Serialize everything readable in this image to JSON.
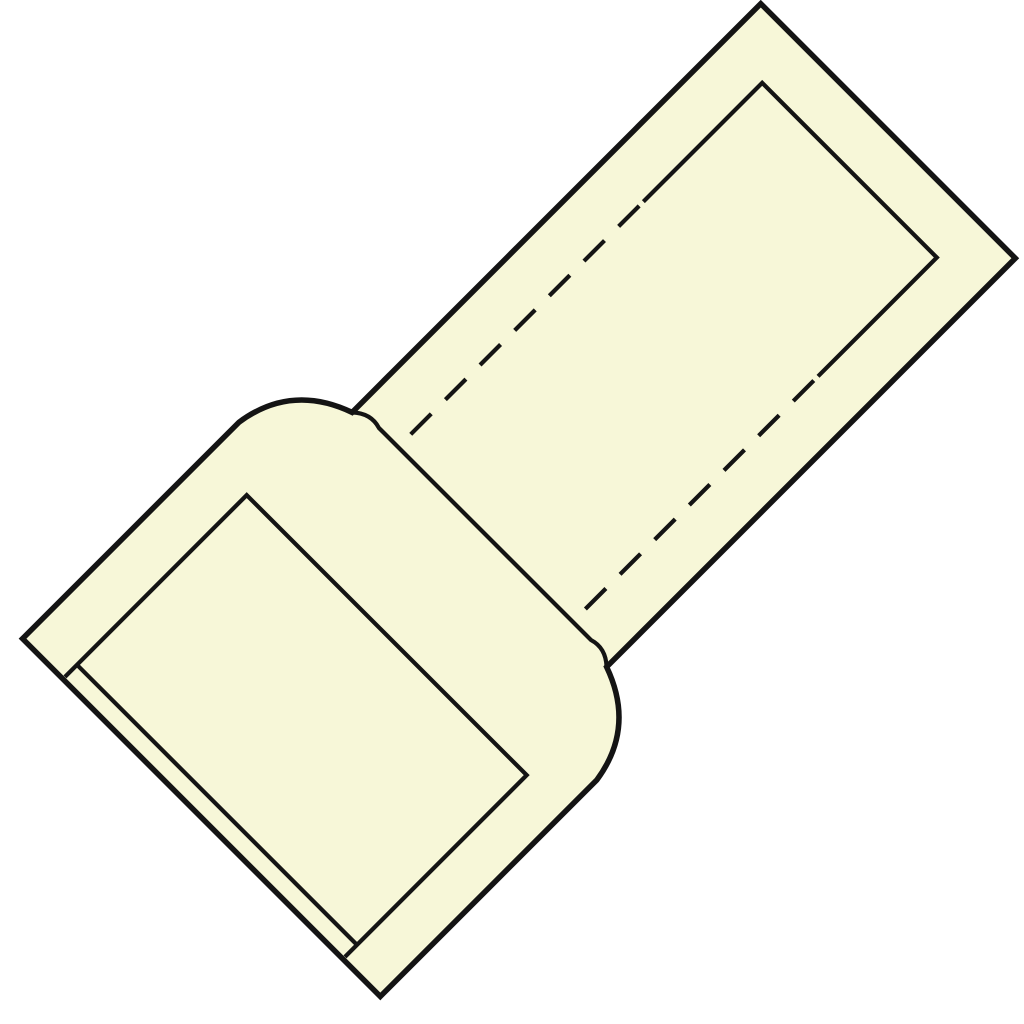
{
  "figure": {
    "name": "insulated-butt-connector-line-drawing",
    "background_color": "#ffffff",
    "body_fill_color": "#f7f7d8",
    "line_color": "#141414",
    "outline_stroke_width": 5.5,
    "inner_stroke_width": 4.2,
    "hidden_line_dash": "29 20",
    "rotation_degrees": -45,
    "parts": {
      "large_sleeve": "large-insulation-sleeve",
      "small_barrel": "small-insulation-barrel",
      "collar": "center-collar-shoulders",
      "sleeve_bore": "large-sleeve-bore-outline",
      "sleeve_rim": "large-sleeve-rim-line",
      "barrel_bore": "barrel-tip-opening-outline",
      "hidden_bore": "hidden-inner-tube-dashed-lines",
      "collar_face": "barrel-end-face-at-collar"
    }
  }
}
